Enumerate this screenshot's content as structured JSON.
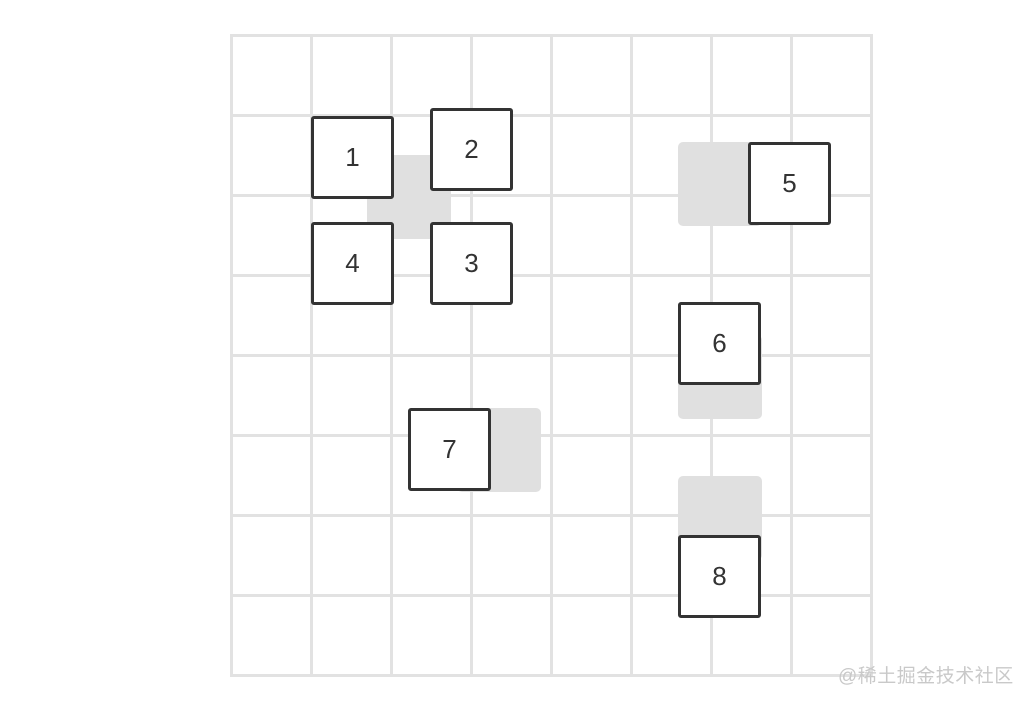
{
  "canvas": {
    "width": 1020,
    "height": 702,
    "background": "#ffffff"
  },
  "grid": {
    "rows": 8,
    "cols": 8,
    "cell_size": 80,
    "left": 230,
    "top": 34,
    "line_color": "#e2e2e2",
    "line_width": 3
  },
  "box_style": {
    "size": 83,
    "border_color": "#333333",
    "border_width": 3,
    "fill": "#ffffff",
    "text_color": "#333333"
  },
  "boxes": [
    {
      "label": "1",
      "x": 311,
      "y": 116
    },
    {
      "label": "2",
      "x": 430,
      "y": 108
    },
    {
      "label": "3",
      "x": 430,
      "y": 222
    },
    {
      "label": "4",
      "x": 311,
      "y": 222
    },
    {
      "label": "5",
      "x": 748,
      "y": 142
    },
    {
      "label": "6",
      "x": 678,
      "y": 302
    },
    {
      "label": "7",
      "x": 408,
      "y": 408
    },
    {
      "label": "8",
      "x": 678,
      "y": 535
    }
  ],
  "shadow_style": {
    "size": 84,
    "color": "#e0e0e0",
    "radius": 5
  },
  "shadows": [
    {
      "x": 367,
      "y": 155
    },
    {
      "x": 678,
      "y": 142
    },
    {
      "x": 678,
      "y": 335
    },
    {
      "x": 678,
      "y": 476
    },
    {
      "x": 457,
      "y": 408
    }
  ],
  "watermark": {
    "text": "@稀土掘金技术社区",
    "color": "#c9c9c9"
  }
}
